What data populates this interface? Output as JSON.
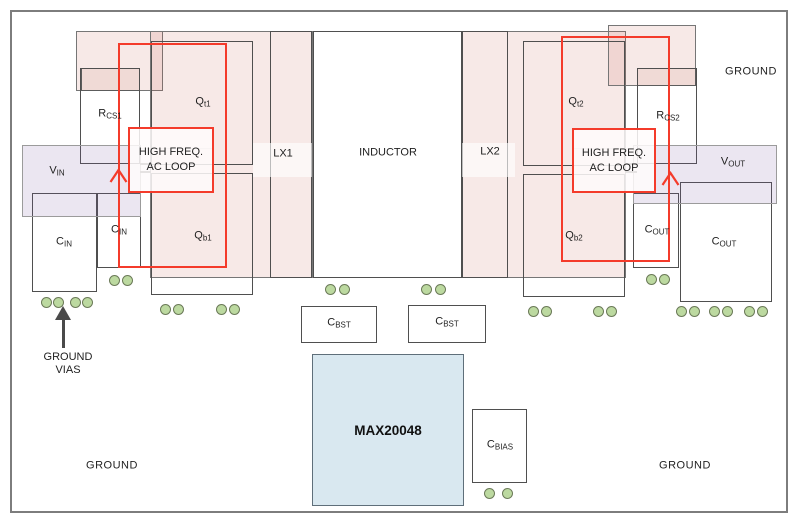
{
  "diagram": {
    "type": "pcb-layout",
    "ic_label": "MAX20048"
  },
  "colors": {
    "copper_pour_pink": "#f2e1dd",
    "plane_purple": "#e9e3f0",
    "loop_red": "#f43b2b",
    "via_green": "#bcd9a0",
    "ic_blue": "#d9e8f0"
  },
  "regions": {
    "ground_top_right": "GROUND",
    "ground_bottom_left": "GROUND",
    "ground_bottom_right": "GROUND",
    "lx1": "LX1",
    "lx2": "LX2",
    "inductor": "INDUCTOR"
  },
  "components": {
    "vin": {
      "base": "V",
      "sub": "IN"
    },
    "cin_large": {
      "base": "C",
      "sub": "IN"
    },
    "cin_small": {
      "base": "C",
      "sub": "IN"
    },
    "rcs1": {
      "base": "R",
      "sub": "CS1"
    },
    "qt1": {
      "base": "Q",
      "sub": "t1"
    },
    "qb1": {
      "base": "Q",
      "sub": "b1"
    },
    "qt2": {
      "base": "Q",
      "sub": "t2"
    },
    "qb2": {
      "base": "Q",
      "sub": "b2"
    },
    "rcs2": {
      "base": "R",
      "sub": "CS2"
    },
    "vout": {
      "base": "V",
      "sub": "OUT"
    },
    "cout_small": {
      "base": "C",
      "sub": "OUT"
    },
    "cout_large": {
      "base": "C",
      "sub": "OUT"
    },
    "cbst_left": {
      "base": "C",
      "sub": "BST"
    },
    "cbst_right": {
      "base": "C",
      "sub": "BST"
    },
    "cbias": {
      "base": "C",
      "sub": "BIAS"
    },
    "ic": {
      "label": "MAX20048"
    }
  },
  "annotations": {
    "hf_loop_left": {
      "line1": "HIGH FREQ.",
      "line2": "AC LOOP"
    },
    "hf_loop_right": {
      "line1": "HIGH FREQ.",
      "line2": "AC LOOP"
    },
    "ground_vias": {
      "line1": "GROUND",
      "line2": "VIAS"
    }
  }
}
